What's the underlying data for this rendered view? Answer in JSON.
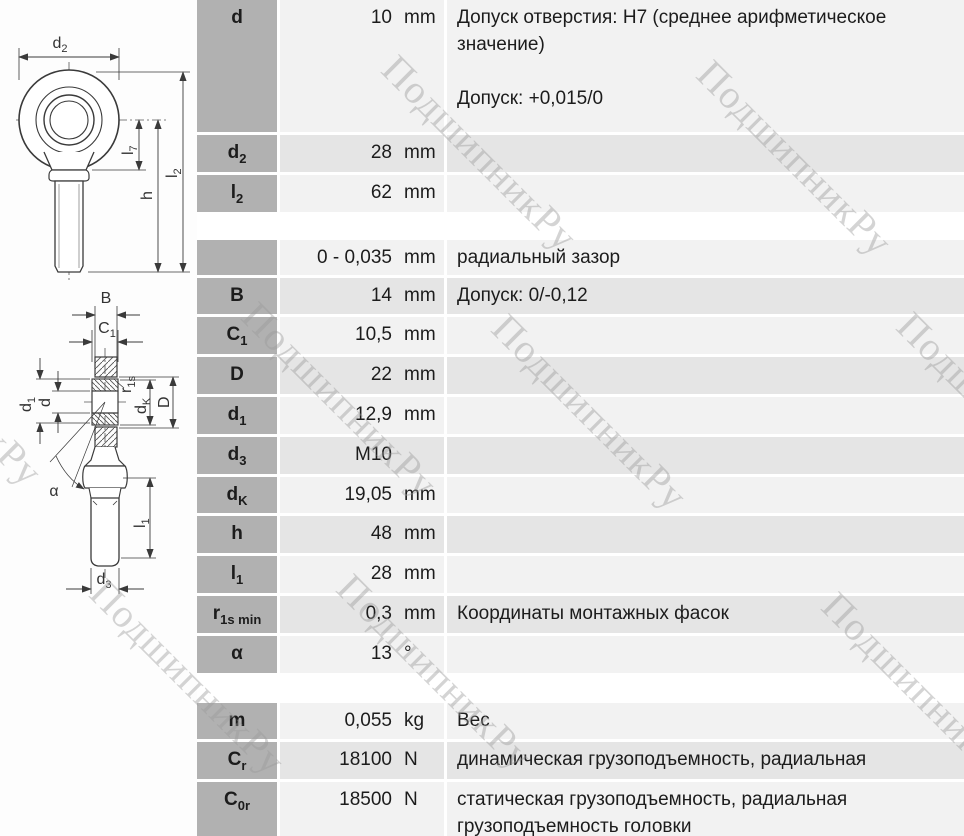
{
  "watermark": {
    "text": "ПодшипникРу",
    "color": "#9a9a9a"
  },
  "colors": {
    "label_cell": "#b1b1b1",
    "stripe_light": "#f2f2f2",
    "stripe_dark": "#e5e5e5",
    "text": "#1c1c1c",
    "page": "#ffffff"
  },
  "drawing_labels": {
    "d2": {
      "main": "d",
      "sub": "2"
    },
    "l7": {
      "main": "l",
      "sub": "7"
    },
    "h": {
      "main": "h",
      "sub": ""
    },
    "l2": {
      "main": "l",
      "sub": "2"
    },
    "B": {
      "main": "B",
      "sub": ""
    },
    "C1": {
      "main": "C",
      "sub": "1"
    },
    "d1": {
      "main": "d",
      "sub": "1"
    },
    "d": {
      "main": "d",
      "sub": ""
    },
    "r1s": {
      "main": "r",
      "sub": "1s"
    },
    "dK": {
      "main": "d",
      "sub": "K"
    },
    "D": {
      "main": "D",
      "sub": ""
    },
    "alpha": {
      "main": "α",
      "sub": ""
    },
    "l1": {
      "main": "l",
      "sub": "1"
    },
    "d3": {
      "main": "d",
      "sub": "3"
    }
  },
  "table": {
    "groups": [
      {
        "rows": [
          {
            "label": {
              "main": "d",
              "sub": ""
            },
            "value": "10",
            "unit": "mm",
            "desc": [
              "Допуск отверстия: H7 (среднее арифметическое значение)",
              "",
              "Допуск: +0,015/0"
            ],
            "stripe": "light",
            "size": "tall-d"
          },
          {
            "label": {
              "main": "d",
              "sub": "2"
            },
            "value": "28",
            "unit": "mm",
            "desc": [],
            "stripe": "dark",
            "size": ""
          },
          {
            "label": {
              "main": "l",
              "sub": "2"
            },
            "value": "62",
            "unit": "mm",
            "desc": [],
            "stripe": "light",
            "size": ""
          }
        ]
      },
      {
        "rows": [
          {
            "label": null,
            "value": "0 - 0,035",
            "unit": "mm",
            "desc": [
              "радиальный зазор"
            ],
            "stripe": "light",
            "size": ""
          },
          {
            "label": {
              "main": "B",
              "sub": ""
            },
            "value": "14",
            "unit": "mm",
            "desc": [
              "Допуск: 0/-0,12"
            ],
            "stripe": "dark",
            "size": ""
          },
          {
            "label": {
              "main": "C",
              "sub": "1"
            },
            "value": "10,5",
            "unit": "mm",
            "desc": [],
            "stripe": "light",
            "size": ""
          },
          {
            "label": {
              "main": "D",
              "sub": ""
            },
            "value": "22",
            "unit": "mm",
            "desc": [],
            "stripe": "dark",
            "size": ""
          },
          {
            "label": {
              "main": "d",
              "sub": "1"
            },
            "value": "12,9",
            "unit": "mm",
            "desc": [],
            "stripe": "light",
            "size": ""
          },
          {
            "label": {
              "main": "d",
              "sub": "3"
            },
            "value": "M10",
            "unit": "",
            "desc": [],
            "stripe": "dark",
            "size": ""
          },
          {
            "label": {
              "main": "d",
              "sub": "K"
            },
            "value": "19,05",
            "unit": "mm",
            "desc": [],
            "stripe": "light",
            "size": ""
          },
          {
            "label": {
              "main": "h",
              "sub": ""
            },
            "value": "48",
            "unit": "mm",
            "desc": [],
            "stripe": "dark",
            "size": ""
          },
          {
            "label": {
              "main": "l",
              "sub": "1"
            },
            "value": "28",
            "unit": "mm",
            "desc": [],
            "stripe": "light",
            "size": ""
          },
          {
            "label": {
              "main": "r",
              "sub": "1s min"
            },
            "value": "0,3",
            "unit": "mm",
            "desc": [
              "Координаты монтажных фасок"
            ],
            "stripe": "dark",
            "size": ""
          },
          {
            "label": {
              "main": "α",
              "sub": ""
            },
            "value": "13",
            "unit": "°",
            "desc": [],
            "stripe": "light",
            "size": ""
          }
        ]
      },
      {
        "rows": [
          {
            "label": {
              "main": "m",
              "sub": ""
            },
            "value": "0,055",
            "unit": "kg",
            "desc": [
              "Вес"
            ],
            "stripe": "light",
            "size": ""
          },
          {
            "label": {
              "main": "C",
              "sub": "r"
            },
            "value": "18100",
            "unit": "N",
            "desc": [
              "динамическая грузоподъемность, радиальная"
            ],
            "stripe": "dark",
            "size": ""
          },
          {
            "label": {
              "main": "C",
              "sub": "0r"
            },
            "value": "18500",
            "unit": "N",
            "desc": [
              "статическая грузоподъемность, радиальная грузоподъемность головки"
            ],
            "stripe": "light",
            "size": "tall-c0r"
          }
        ]
      },
      {
        "rows": [
          {
            "label": {
              "main": "",
              "sub": ""
            },
            "value": "",
            "unit": "",
            "desc": [],
            "stripe": "dark",
            "size": "cutoff"
          }
        ]
      }
    ]
  }
}
